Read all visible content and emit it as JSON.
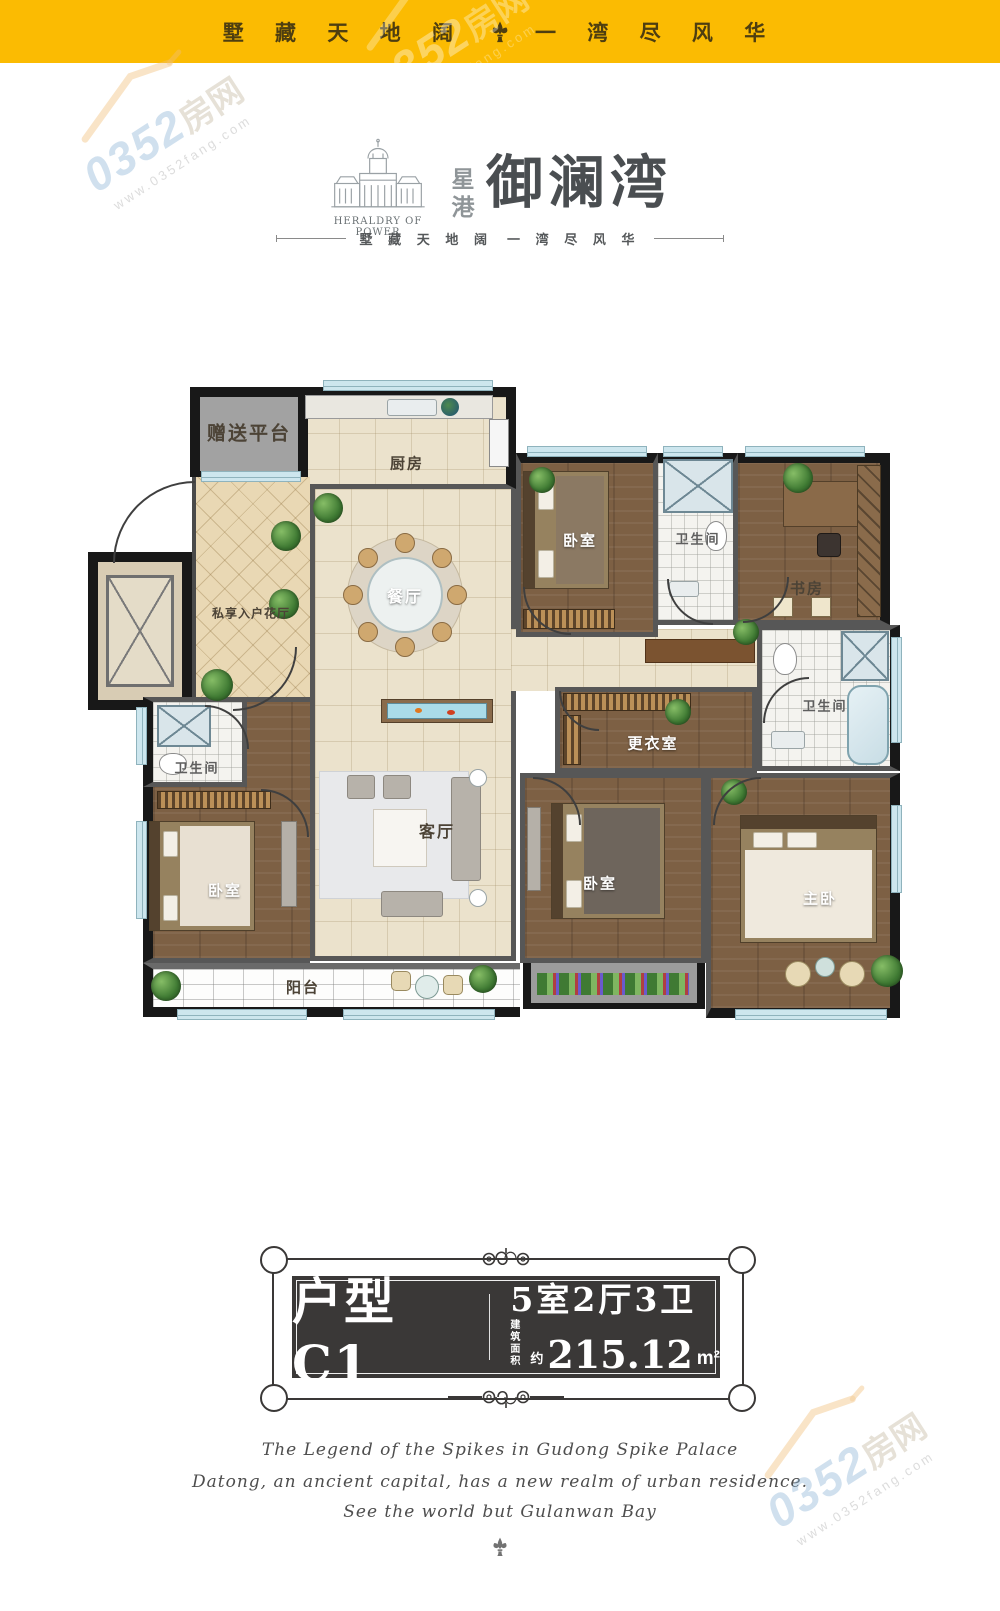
{
  "header": {
    "tagline_left": "墅 藏 天 地 阔",
    "tagline_right": "一 湾 尽 风 华"
  },
  "logo": {
    "heraldry": "HERALDRY OF POWER",
    "seal_top": "星",
    "seal_bottom": "港",
    "title": "御澜湾",
    "sub_left": "墅 藏 天 地 阔",
    "sub_right": "一 湾 尽 风 华"
  },
  "floorplan": {
    "rooms": [
      {
        "id": "platform",
        "label": "赠送平台"
      },
      {
        "id": "kitchen",
        "label": "厨房"
      },
      {
        "id": "dining",
        "label": "餐厅"
      },
      {
        "id": "flower_hall",
        "label": "私享入户花厅"
      },
      {
        "id": "bedroom_tr",
        "label": "卧室"
      },
      {
        "id": "bath_top",
        "label": "卫生间"
      },
      {
        "id": "study",
        "label": "书房"
      },
      {
        "id": "bath_right",
        "label": "卫生间"
      },
      {
        "id": "dressing",
        "label": "更衣室"
      },
      {
        "id": "living",
        "label": "客厅"
      },
      {
        "id": "bath_left",
        "label": "卫生间"
      },
      {
        "id": "bedroom_left",
        "label": "卧室"
      },
      {
        "id": "bedroom_bottom",
        "label": "卧室"
      },
      {
        "id": "master",
        "label": "主卧"
      },
      {
        "id": "balcony",
        "label": "阳台"
      }
    ]
  },
  "badge": {
    "unit_label": "户型C1",
    "rooms_label": "5室2厅3卫",
    "area_word_1": "建筑",
    "area_word_2": "面积",
    "area_approx": "约",
    "area_value": "215.12",
    "area_unit": "m²"
  },
  "footer": {
    "lines": [
      "The Legend of the Spikes in Gudong Spike Palace",
      "Datong, an ancient capital, has a new realm of urban residence.",
      "See the world but Gulanwan Bay"
    ]
  },
  "watermark": {
    "number": "0352",
    "suffix": "房网",
    "url": "www.0352fang.com"
  },
  "colors": {
    "accent_yellow": "#fbbb02",
    "badge_dark": "#3a3837",
    "wall_black": "#181818",
    "wood_floor": "#7d6044",
    "window_blue": "#cde6ee"
  }
}
